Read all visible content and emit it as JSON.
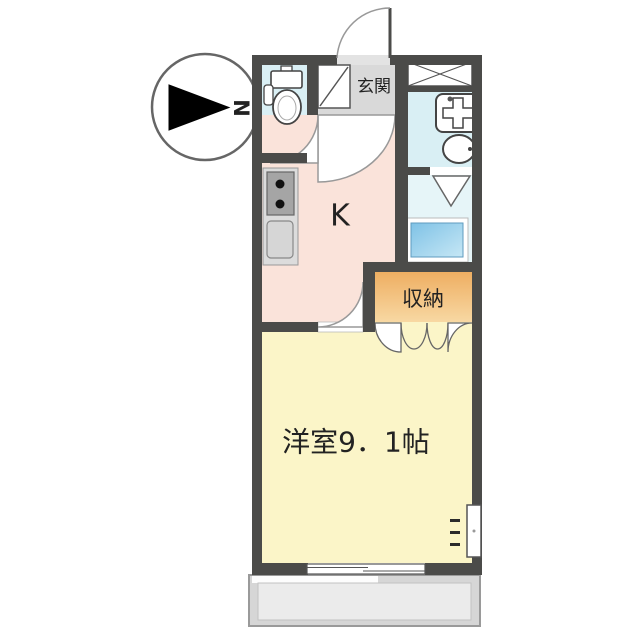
{
  "page": {
    "type": "apartment-floor-plan",
    "background": "#ffffff"
  },
  "compass": {
    "north_label": "N",
    "points": "right"
  },
  "labels": {
    "entrance": "玄関",
    "kitchen": "K",
    "closet": "収納",
    "main_room": "洋室9．1帖"
  },
  "colors": {
    "wall": "#4b4b49",
    "entrance_floor": "#d9d9d9",
    "entrance_gap": "#e3e3e3",
    "kitchen_floor": "#fae3da",
    "main_room_floor": "#fbf5c8",
    "toilet_floor": "#d9eff4",
    "bathroom_floor": "#d9eff4",
    "washroom_floor": "#e6f5f8",
    "closet_top": "#eeae62",
    "closet_bottom": "#f8d9a4",
    "washer_pan_top": "#7fc2e6",
    "washer_pan_bottom": "#c6e7f5",
    "balcony": "#d6d6d6",
    "balcony_inner": "#ebebeb",
    "counter": "#dcdcdc",
    "stove": "#a5a5a5",
    "text": "#222222"
  },
  "fixtures": {
    "toilet": "toilet-icon",
    "shoe_cabinet": "shoe-cabinet-diagonal-icon",
    "pipe_space": "crossed-box-icon",
    "bathtub": "bathtub-icon",
    "wash_basin": "basin-icon",
    "stove": "two-burner-stove-icon",
    "kitchen_sink": "kitchen-sink-icon",
    "washer_pan": "washing-machine-pan-icon",
    "bottom_window": "sliding-window-icon",
    "side_window": "wall-window-icon",
    "entrance_door": "entrance-door-swing-icon",
    "closet_doors": "folding-closet-doors-icon"
  }
}
